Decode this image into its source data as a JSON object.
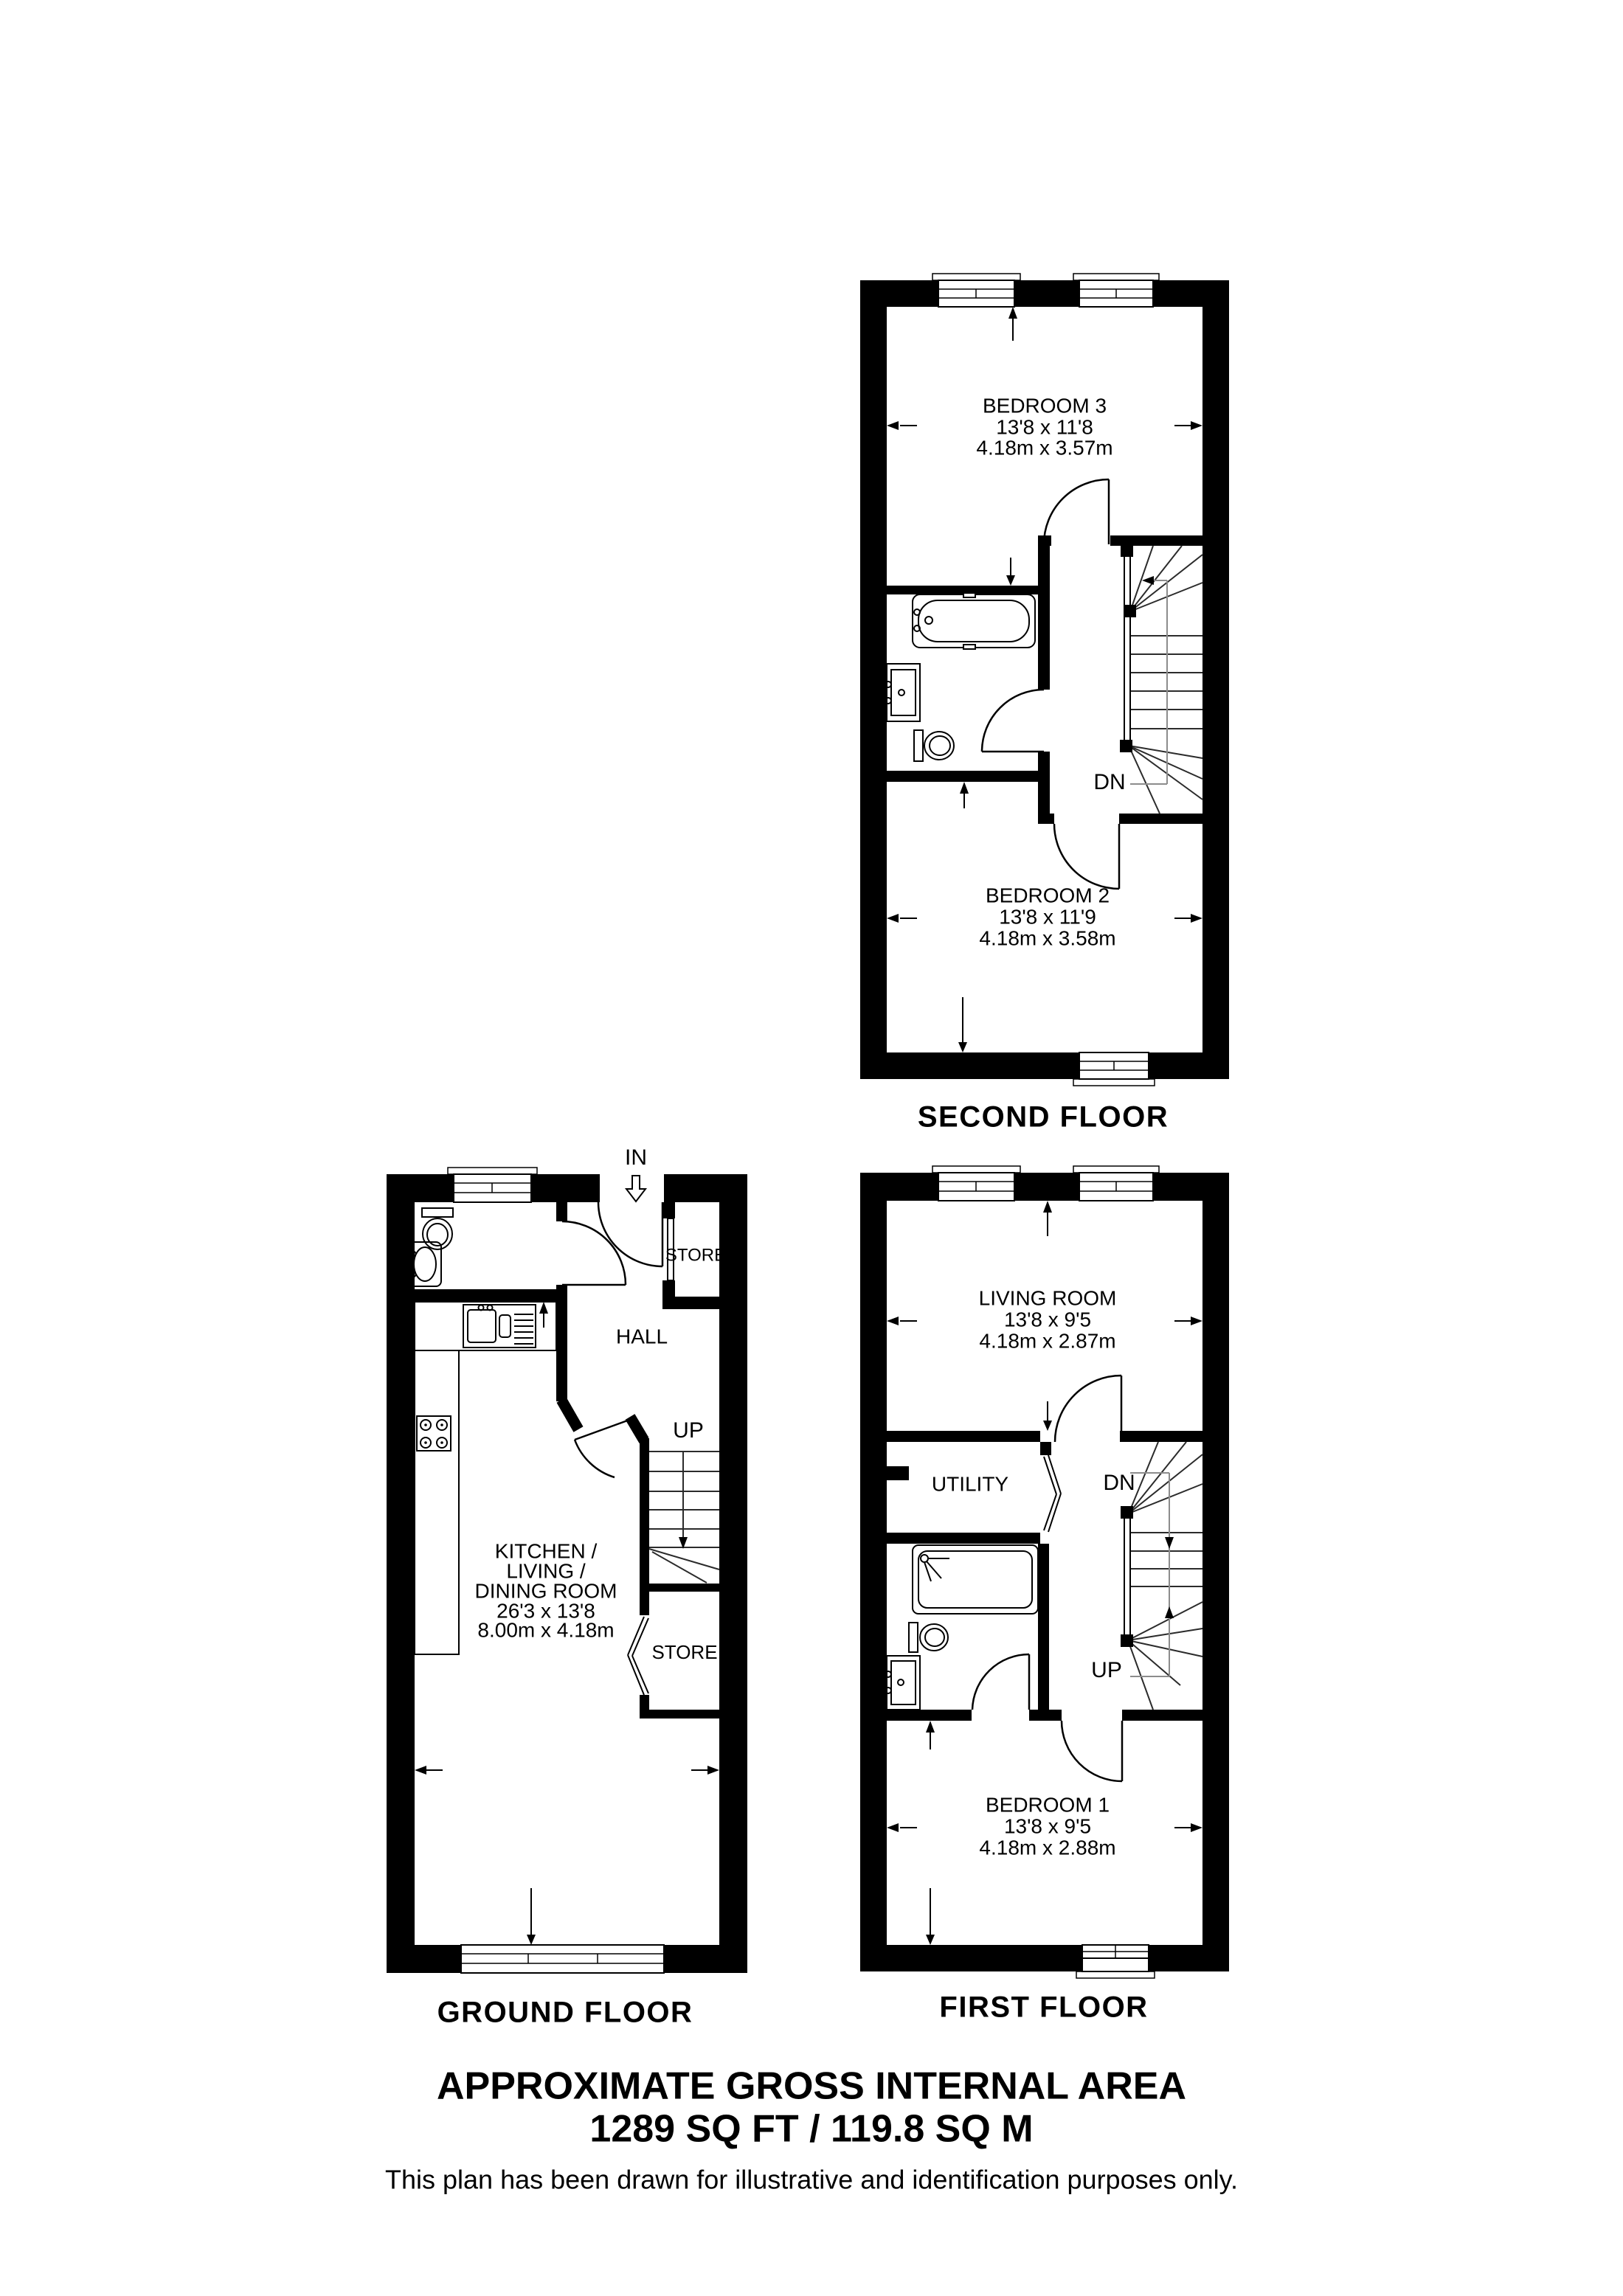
{
  "document": {
    "type": "floorplan",
    "background_color": "#ffffff",
    "line_color": "#000000",
    "guide_color": "#8c8c8c"
  },
  "floors": {
    "second": {
      "floor_label": "SECOND FLOOR",
      "bedroom3": {
        "name": "BEDROOM 3",
        "imperial": "13'8 x 11'8",
        "metric": "4.18m x 3.57m"
      },
      "bedroom2": {
        "name": "BEDROOM 2",
        "imperial": "13'8 x 11'9",
        "metric": "4.18m x 3.58m"
      },
      "stair_label": "DN"
    },
    "ground": {
      "floor_label": "GROUND FLOOR",
      "entrance_label": "IN",
      "hall_label": "HALL",
      "stair_label": "UP",
      "store_top_label": "STORE",
      "store_stairs_label": "STORE",
      "kitchen": {
        "line1": "KITCHEN /",
        "line2": "LIVING /",
        "line3": "DINING ROOM",
        "imperial": "26'3 x 13'8",
        "metric": "8.00m x 4.18m"
      }
    },
    "first": {
      "floor_label": "FIRST FLOOR",
      "living": {
        "name": "LIVING ROOM",
        "imperial": "13'8 x 9'5",
        "metric": "4.18m x 2.87m"
      },
      "utility_label": "UTILITY",
      "bedroom1": {
        "name": "BEDROOM 1",
        "imperial": "13'8 x 9'5",
        "metric": "4.18m x 2.88m"
      },
      "stair_down_label": "DN",
      "stair_up_label": "UP"
    }
  },
  "footer": {
    "title": "APPROXIMATE GROSS INTERNAL AREA",
    "area": "1289 SQ FT / 119.8 SQ M",
    "disclaimer": "This plan has been drawn for illustrative and identification purposes only."
  }
}
